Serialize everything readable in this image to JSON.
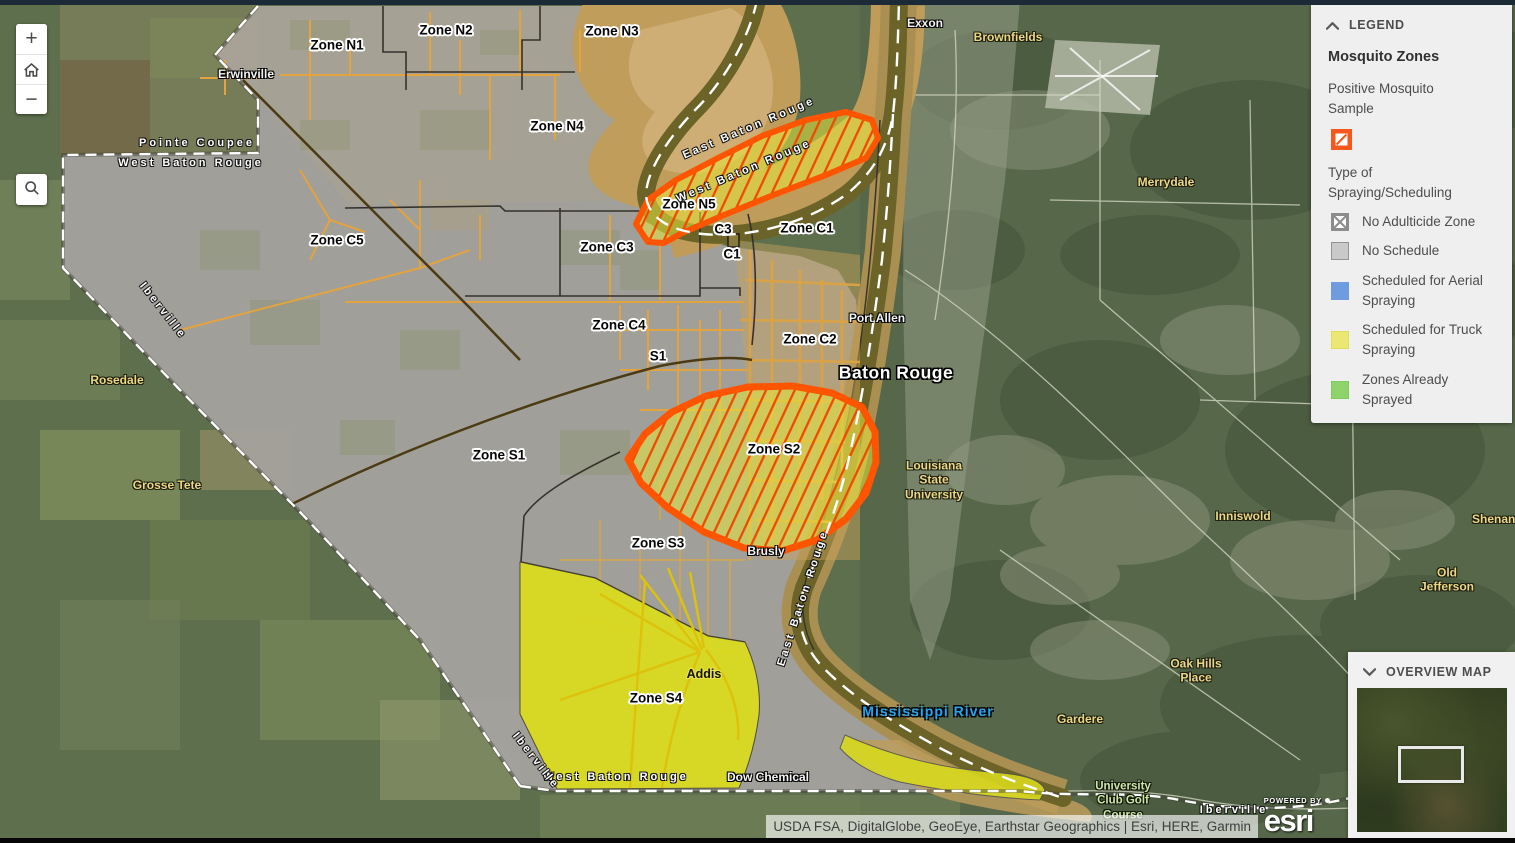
{
  "controls": {
    "zoom_in_label": "+",
    "zoom_out_label": "−"
  },
  "legend": {
    "header": "LEGEND",
    "title": "Mosquito Zones",
    "positive_sample": {
      "label": "Positive Mosquito Sample",
      "fill": "#f4581c"
    },
    "type_section_label": "Type of Spraying/Scheduling",
    "items": [
      {
        "label": "No Adulticide Zone",
        "swatch": "crossed",
        "fill": "#ffffff",
        "border": "#8c8c8c"
      },
      {
        "label": "No Schedule",
        "swatch": "plain",
        "fill": "#c9c9c9",
        "border": "#949494"
      },
      {
        "label": "Scheduled for Aerial Spraying",
        "swatch": "plain",
        "fill": "#6f9bdf",
        "border": "#6f9bdf"
      },
      {
        "label": "Scheduled for Truck Spraying",
        "swatch": "plain",
        "fill": "#eae873",
        "border": "#e0dc60"
      },
      {
        "label": "Zones Already Sprayed",
        "swatch": "plain",
        "fill": "#8fd36b",
        "border": "#82c95e"
      }
    ]
  },
  "overview": {
    "header": "OVERVIEW MAP"
  },
  "attribution": {
    "text": "USDA FSA, DigitalGlobe, GeoEye, Earthstar Geographics | Esri, HERE, Garmin",
    "powered_by": "POWERED BY",
    "esri": "esri"
  },
  "map": {
    "zone_fill_colors": {
      "no_schedule_overlay": "#a6a29f",
      "truck_spray_yellow": "#dcdd1d",
      "positive_sample_outline": "#ff5400",
      "positive_sample_hatch": "#f04a00"
    },
    "labels": [
      {
        "text": "Zone N1",
        "x": 337,
        "y": 45,
        "cls": "zone"
      },
      {
        "text": "Zone N2",
        "x": 446,
        "y": 30,
        "cls": "zone"
      },
      {
        "text": "Zone N3",
        "x": 612,
        "y": 31,
        "cls": "zone"
      },
      {
        "text": "Zone N4",
        "x": 557,
        "y": 126,
        "cls": "zone"
      },
      {
        "text": "Zone N5",
        "x": 689,
        "y": 204,
        "cls": "zone"
      },
      {
        "text": "Zone C5",
        "x": 337,
        "y": 240,
        "cls": "zone"
      },
      {
        "text": "Zone C3",
        "x": 607,
        "y": 247,
        "cls": "zone"
      },
      {
        "text": "C3",
        "x": 723,
        "y": 229,
        "cls": "zone"
      },
      {
        "text": "C1",
        "x": 732,
        "y": 254,
        "cls": "zone"
      },
      {
        "text": "Zone C1",
        "x": 807,
        "y": 228,
        "cls": "zone"
      },
      {
        "text": "Zone C4",
        "x": 619,
        "y": 325,
        "cls": "zone"
      },
      {
        "text": "S1",
        "x": 658,
        "y": 356,
        "cls": "zone"
      },
      {
        "text": "Zone C2",
        "x": 810,
        "y": 339,
        "cls": "zone"
      },
      {
        "text": "Zone S1",
        "x": 499,
        "y": 455,
        "cls": "zone"
      },
      {
        "text": "Zone S2",
        "x": 774,
        "y": 449,
        "cls": "zone"
      },
      {
        "text": "Zone S3",
        "x": 658,
        "y": 543,
        "cls": "zone"
      },
      {
        "text": "Zone S4",
        "x": 656,
        "y": 698,
        "cls": "zone"
      },
      {
        "text": "Pointe Coupee",
        "x": 197,
        "y": 143,
        "cls": "parish"
      },
      {
        "text": "West Baton Rouge",
        "x": 191,
        "y": 163,
        "cls": "parish"
      },
      {
        "text": "East Baton Rouge",
        "x": 749,
        "y": 128,
        "cls": "parish",
        "rot": -23
      },
      {
        "text": "West Baton Rouge",
        "x": 744,
        "y": 171,
        "cls": "parish",
        "rot": -23
      },
      {
        "text": "East Baton Rouge",
        "x": 803,
        "y": 598,
        "cls": "parish",
        "rot": -72
      },
      {
        "text": "West Baton Rouge",
        "x": 616,
        "y": 777,
        "cls": "parish"
      },
      {
        "text": "Iberville",
        "x": 163,
        "y": 311,
        "cls": "parish",
        "rot": 52
      },
      {
        "text": "Iberville",
        "x": 536,
        "y": 761,
        "cls": "parish",
        "rot": 52
      },
      {
        "text": "Iberville",
        "x": 1234,
        "y": 810,
        "cls": "parish"
      },
      {
        "text": "Erwinville",
        "x": 246,
        "y": 74,
        "cls": "town"
      },
      {
        "text": "Port Allen",
        "x": 877,
        "y": 318,
        "cls": "town"
      },
      {
        "text": "Baton Rouge",
        "x": 896,
        "y": 373,
        "cls": "city"
      },
      {
        "text": "Brusly",
        "x": 766,
        "y": 551,
        "cls": "town"
      },
      {
        "text": "Addis",
        "x": 704,
        "y": 674,
        "cls": "addis"
      },
      {
        "text": "Dow Chemical",
        "x": 768,
        "y": 777,
        "cls": "town"
      },
      {
        "text": "Exxon",
        "x": 925,
        "y": 23,
        "cls": "town"
      },
      {
        "text": "Brownfields",
        "x": 1008,
        "y": 37,
        "cls": "place"
      },
      {
        "text": "Merrydale",
        "x": 1166,
        "y": 182,
        "cls": "place"
      },
      {
        "text": "Rosedale",
        "x": 117,
        "y": 380,
        "cls": "place"
      },
      {
        "text": "Grosse Tete",
        "x": 167,
        "y": 485,
        "cls": "place"
      },
      {
        "text": "Louisiana\nState\nUniversity",
        "x": 934,
        "y": 480,
        "cls": "place"
      },
      {
        "text": "Inniswold",
        "x": 1243,
        "y": 516,
        "cls": "place"
      },
      {
        "text": "Shenandoah",
        "x": 1508,
        "y": 519,
        "cls": "place"
      },
      {
        "text": "Old Jefferson",
        "x": 1447,
        "y": 580,
        "cls": "place"
      },
      {
        "text": "Oak Hills\nPlace",
        "x": 1196,
        "y": 671,
        "cls": "place"
      },
      {
        "text": "Gardere",
        "x": 1080,
        "y": 719,
        "cls": "place"
      },
      {
        "text": "University\nClub Golf\nCourse",
        "x": 1123,
        "y": 801,
        "cls": "golf"
      },
      {
        "text": "Mississippi River",
        "x": 928,
        "y": 711,
        "cls": "water"
      }
    ]
  }
}
